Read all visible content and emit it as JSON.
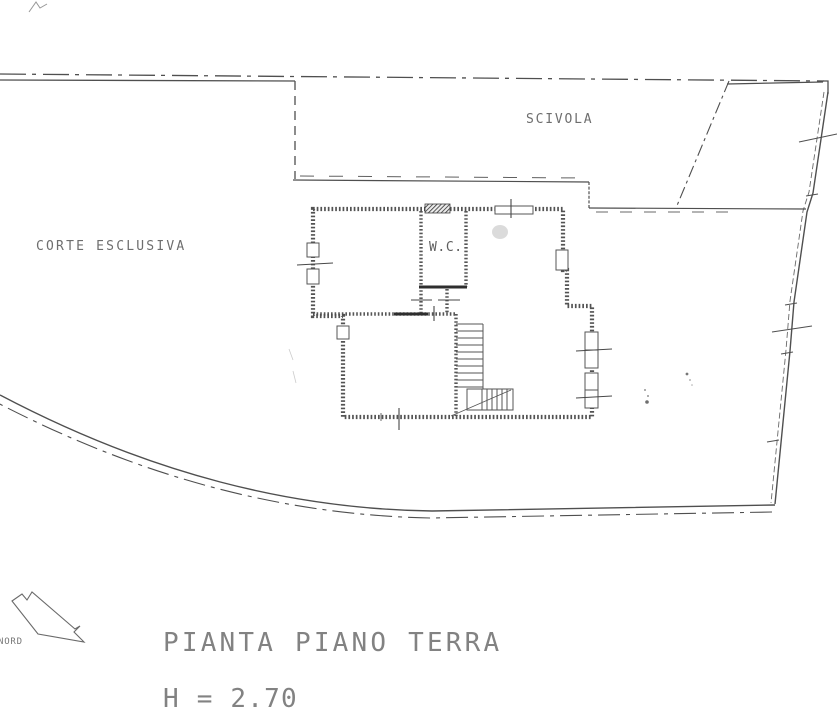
{
  "sheet": {
    "labels": {
      "corte_esclusiva": "CORTE ESCLUSIVA",
      "scivola": "SCIVOLA",
      "wc": "W.C.",
      "nord": "NORD"
    },
    "caption": {
      "title": "PIANTA PIANO TERRA",
      "height": "H = 2.70"
    },
    "colors": {
      "paper": "#ffffff",
      "ink": "#4a4a4a",
      "label_text": "#6e6e6e",
      "title_text": "#828282"
    }
  }
}
